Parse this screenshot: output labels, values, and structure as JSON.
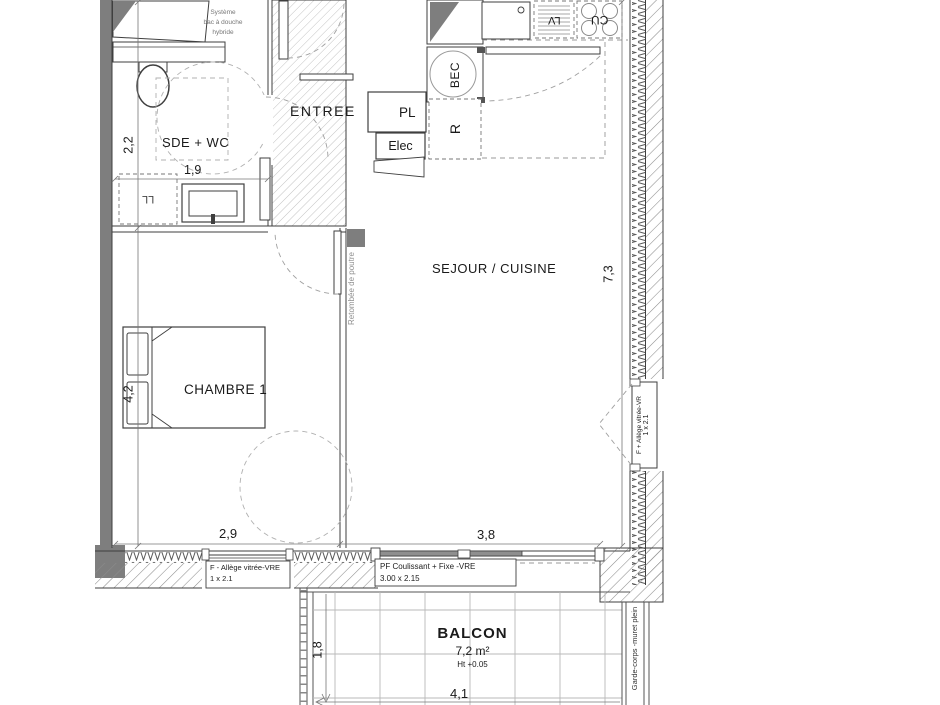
{
  "rooms": {
    "sde": {
      "label": "SDE + WC"
    },
    "entree": {
      "label": "ENTREE"
    },
    "sejour": {
      "label": "SEJOUR / CUISINE"
    },
    "chambre": {
      "label": "CHAMBRE 1"
    },
    "balcon": {
      "label": "BALCON",
      "area": "7,2 m²",
      "height_note": "Ht +0.05"
    }
  },
  "equipment": {
    "placard": "PL",
    "elec": "Elec",
    "refrigerateur": "R",
    "bec": "BEC",
    "lave_vaisselle": "LV",
    "cuisson": "CU",
    "lave_linge": "LL",
    "shower_note_line1": "Système",
    "shower_note_line2": "bac à douche",
    "shower_note_line3": "hybride"
  },
  "dimensions": {
    "sde_width": "1,9",
    "sde_depth": "2,2",
    "chambre_depth": "4,2",
    "chambre_width": "2,9",
    "sejour_window_width": "3,8",
    "sejour_depth": "7,3",
    "balcon_depth": "1,8",
    "balcon_width": "4,1"
  },
  "annotations": {
    "beam": "Retombée de poutre",
    "guardrail": "Garde-corps -muret plein",
    "window_right_line1": "F + Allège vitrée-VR",
    "window_right_line2": "1 x 2.1",
    "window_chambre_line1": "F - Allège vitrée-VRE",
    "window_chambre_line2": "1 x 2.1",
    "window_sejour_line1": "PF Coulissant + Fixe -VRE",
    "window_sejour_line2": "3.00 x 2.15"
  },
  "colors": {
    "wall_fill": "#7e7e7e",
    "line": "#3f3f3f",
    "dashed": "#a0a0a0"
  }
}
